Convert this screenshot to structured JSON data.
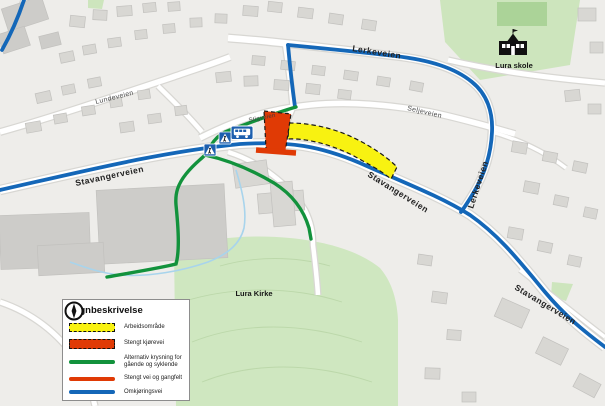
{
  "map": {
    "street_labels": [
      {
        "text": "Stavangerveien"
      },
      {
        "text": "Stavangerveien"
      },
      {
        "text": "Stavangerveien"
      },
      {
        "text": "Lerkeveien"
      },
      {
        "text": "Lerkeveien"
      },
      {
        "text": "Lundeveien"
      },
      {
        "text": "Seljeveien"
      },
      {
        "text": "Stigveien"
      }
    ],
    "places": [
      {
        "text": "Lura skole"
      },
      {
        "text": "Lura Kirke"
      }
    ],
    "colors": {
      "detour_blue": "#1467b8",
      "alternative_green": "#12923c",
      "work_area_yellow": "#f8f211",
      "closed_red": "#e03a05",
      "park_green": "#cfe7c0",
      "water_blue": "#a8d4ec"
    }
  },
  "legend": {
    "title": "Tegnbeskrivelse",
    "items": [
      {
        "label": "Arbeidsområde"
      },
      {
        "label": "Stengt kjørevei"
      },
      {
        "label": "Alternativ krysning for gående og syklende"
      },
      {
        "label": "Stengt vei og gangfelt"
      },
      {
        "label": "Omkjøringsvei"
      }
    ]
  }
}
